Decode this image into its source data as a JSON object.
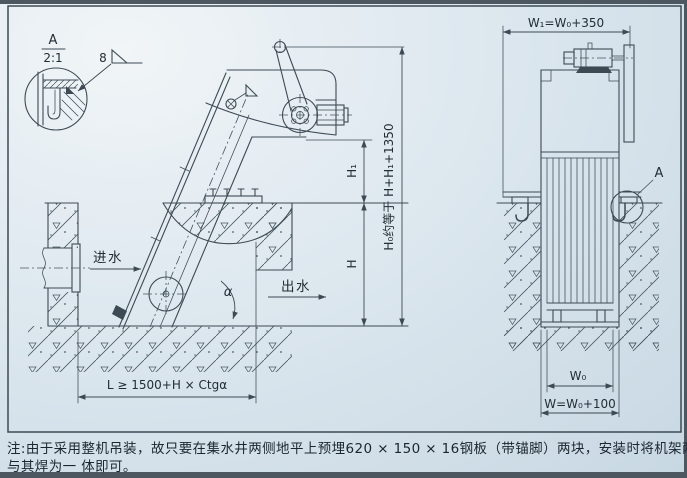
{
  "detail_callout": {
    "view_label": "A",
    "view_scale": "2:1",
    "weld_size": "8"
  },
  "side_view": {
    "inlet_label": "进水",
    "outlet_label": "出水",
    "angle_label": "α",
    "dim_h1": "H₁",
    "dim_h": "H",
    "dim_h0": "H₀约等于 H+H₁+1350",
    "dim_length": "L ≥ 1500+H × Ctgα"
  },
  "front_view": {
    "dim_w1": "W₁=W₀+350",
    "dim_w0": "W₀",
    "dim_w": "W=W₀+100",
    "detail_marker_label": "A"
  },
  "note": {
    "line1": "注:由于采用整机吊装，故只要在集水井两侧地平上预埋620 × 150 × 16钢板（带锚脚）两块，安装时将机架两侧的支承钢板",
    "line2": "与其焊为一 体即可。"
  }
}
